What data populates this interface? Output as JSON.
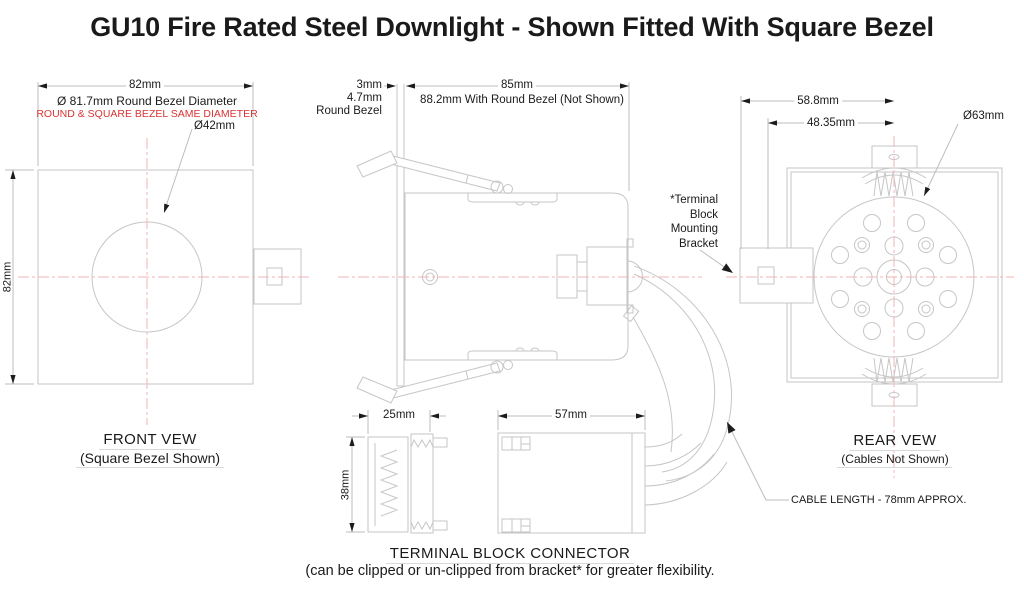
{
  "title": "GU10 Fire Rated Steel Downlight - Shown Fitted With Square Bezel",
  "accent_red": "#d93434",
  "front_view": {
    "dim_width": "82mm",
    "dim_height": "82mm",
    "bezel_diameter_note": "Ø 81.7mm Round Bezel Diameter",
    "bezel_same_note": "ROUND & SQUARE BEZEL SAME DIAMETER",
    "hole_diameter": "Ø42mm",
    "caption": "FRONT VEW",
    "subcaption": "(Square Bezel Shown)"
  },
  "side_view": {
    "bezel_thickness": "3mm",
    "round_bezel_thickness": "4.7mm",
    "round_bezel_label": "Round Bezel",
    "dim_width": "85mm",
    "dim_width_note": "88.2mm With Round Bezel (Not Shown)"
  },
  "rear_view": {
    "dim_outer": "58.8mm",
    "dim_inner": "48.35mm",
    "circle_diameter": "Ø63mm",
    "bracket_label_lines": [
      "*Terminal",
      "Block",
      "Mounting",
      "Bracket"
    ],
    "caption": "REAR VEW",
    "subcaption": "(Cables Not Shown)",
    "cable_note": "CABLE LENGTH - 78mm APPROX."
  },
  "terminal_block": {
    "dim_width_side": "25mm",
    "dim_height": "38mm",
    "dim_width_top": "57mm",
    "caption": "TERMINAL BLOCK CONNECTOR",
    "subcaption": "(can be clipped or un-clipped from bracket* for greater flexibility."
  }
}
